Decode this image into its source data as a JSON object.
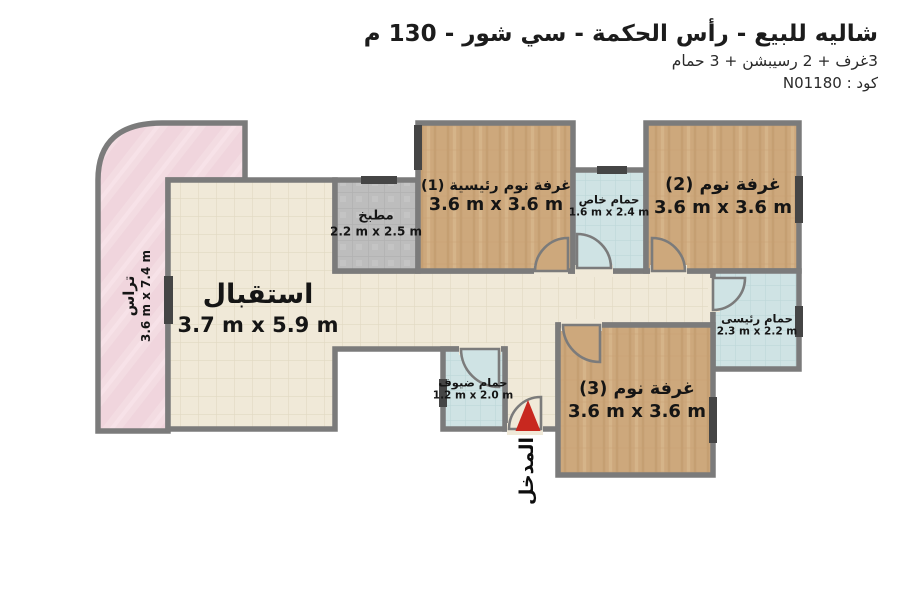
{
  "header": {
    "title": "شاليه للبيع - رأس الحكمة - سي شور - 130 م",
    "subtitle": "3غرف + 2 رسيبشن + 3 حمام",
    "code": "كود : N01180"
  },
  "rooms": {
    "terrace": {
      "label": "تراس",
      "dims": "3.6 m x 7.4 m"
    },
    "reception": {
      "label": "استقبال",
      "dims": "3.7 m x 5.9 m"
    },
    "kitchen": {
      "label": "مطبخ",
      "dims": "2.2 m x 2.5 m"
    },
    "bedroom1": {
      "label": "غرفة نوم رئيسية (1)",
      "dims": "3.6 m x 3.6 m"
    },
    "bedroom2": {
      "label": "غرفة نوم (2)",
      "dims": "3.6 m x 3.6 m"
    },
    "bedroom3": {
      "label": "غرفة نوم (3)",
      "dims": "3.6 m x 3.6 m"
    },
    "private_bathroom": {
      "label": "حمام خاص",
      "dims": "1.6 m x 2.4 m"
    },
    "main_bathroom": {
      "label": "حمام رئيسى",
      "dims": "2.3 m x 2.2 m"
    },
    "guest_bathroom": {
      "label": "حمام ضيوف",
      "dims": "1.2 m x 2.0 m"
    }
  },
  "entrance": {
    "label": "المدخل"
  },
  "colors": {
    "wall": "#7b7b7b",
    "entrance_arrow": "#c8281f",
    "floor_tile": "#f0e9d8",
    "floor_wood": "#cda87c",
    "floor_bath": "#cfe3e4",
    "floor_kitchen": "#bdbdbd",
    "floor_terrace": "#f3dce2",
    "window": "#454545",
    "text": "#1c1c1c"
  }
}
